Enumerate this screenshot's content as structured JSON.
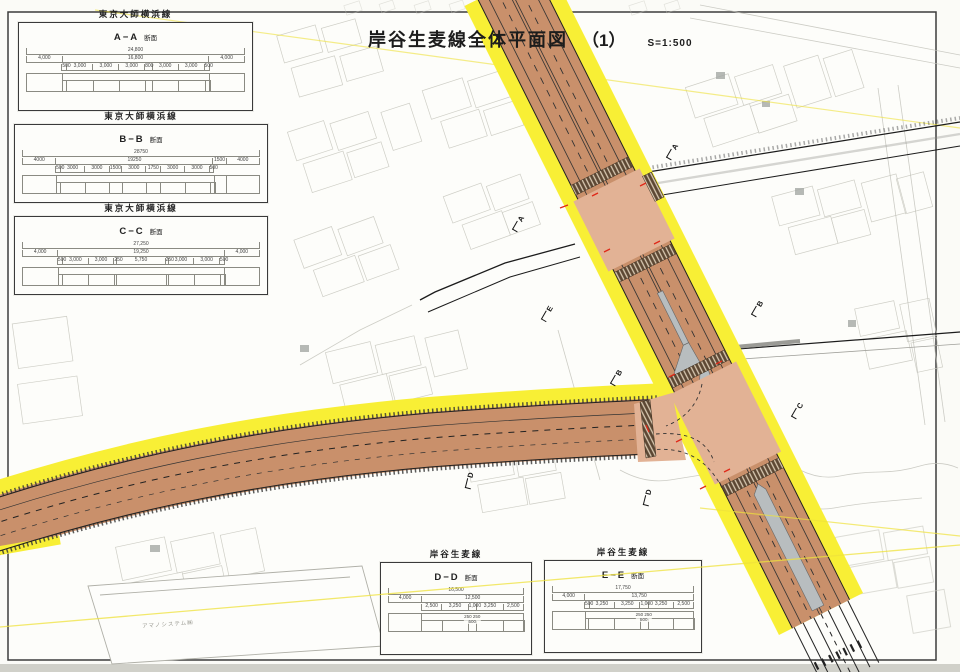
{
  "drawing": {
    "title": "岸谷生麦線全体平面図",
    "sheet": "（1）",
    "scale": "S=1:500"
  },
  "colors": {
    "row_highlight": "#f8ef35",
    "pavement": "#c9906b",
    "intersection": "#e2b295",
    "median_island": "#b8bdbf",
    "crosswalk": "#5c4733",
    "boundary_line": "#efe23c"
  },
  "sections": [
    {
      "road": "東京大師横浜線",
      "code": "A−A",
      "suffix": "断面",
      "total": "24,800",
      "row2": [
        "4,000",
        "16,800",
        "4,000"
      ],
      "row3": [
        "500",
        "3,000",
        "3,000",
        "3,000",
        "800",
        "3,000",
        "3,000",
        "500"
      ]
    },
    {
      "road": "東京大師横浜線",
      "code": "B−B",
      "suffix": "断面",
      "total": "28750",
      "row2": [
        "4000",
        "19250",
        "1500",
        "4000"
      ],
      "row3": [
        "500",
        "3000",
        "3000",
        "1500",
        "3000",
        "1750",
        "3000",
        "3000",
        "500"
      ]
    },
    {
      "road": "東京大師横浜線",
      "code": "C−C",
      "suffix": "断面",
      "total": "27,250",
      "row2": [
        "4,000",
        "19,250",
        "4,000"
      ],
      "row3": [
        "500",
        "3,000",
        "3,000",
        "250",
        "5,750",
        "250",
        "3,000",
        "3,000",
        "500"
      ]
    },
    {
      "road": "岸谷生麦線",
      "code": "D−D",
      "suffix": "断面",
      "total": "16,500",
      "row2": [
        "4,000",
        "12,500"
      ],
      "row3": [
        "2,500",
        "3,250",
        "1,000",
        "3,250",
        "2,500"
      ],
      "center": [
        "250 250",
        "500"
      ]
    },
    {
      "road": "岸谷生麦線",
      "code": "E−E",
      "suffix": "断面",
      "total": "17,750",
      "row2": [
        "4,000",
        "13,750"
      ],
      "row3": [
        "500",
        "3,250",
        "3,250",
        "1,000",
        "3,250",
        "2,500"
      ],
      "center": [
        "250 250",
        "500"
      ]
    }
  ],
  "markers": [
    {
      "letter": "A",
      "x": 510,
      "y": 220,
      "rot": -60
    },
    {
      "letter": "A",
      "x": 664,
      "y": 148,
      "rot": -60
    },
    {
      "letter": "E",
      "x": 539,
      "y": 310,
      "rot": -60
    },
    {
      "letter": "B",
      "x": 608,
      "y": 374,
      "rot": -60
    },
    {
      "letter": "B",
      "x": 749,
      "y": 305,
      "rot": -60
    },
    {
      "letter": "C",
      "x": 789,
      "y": 407,
      "rot": -60
    },
    {
      "letter": "D",
      "x": 461,
      "y": 477,
      "rot": -76
    },
    {
      "letter": "D",
      "x": 639,
      "y": 494,
      "rot": -76
    }
  ],
  "map_labels": {
    "building": "アマノシステム㈱"
  }
}
